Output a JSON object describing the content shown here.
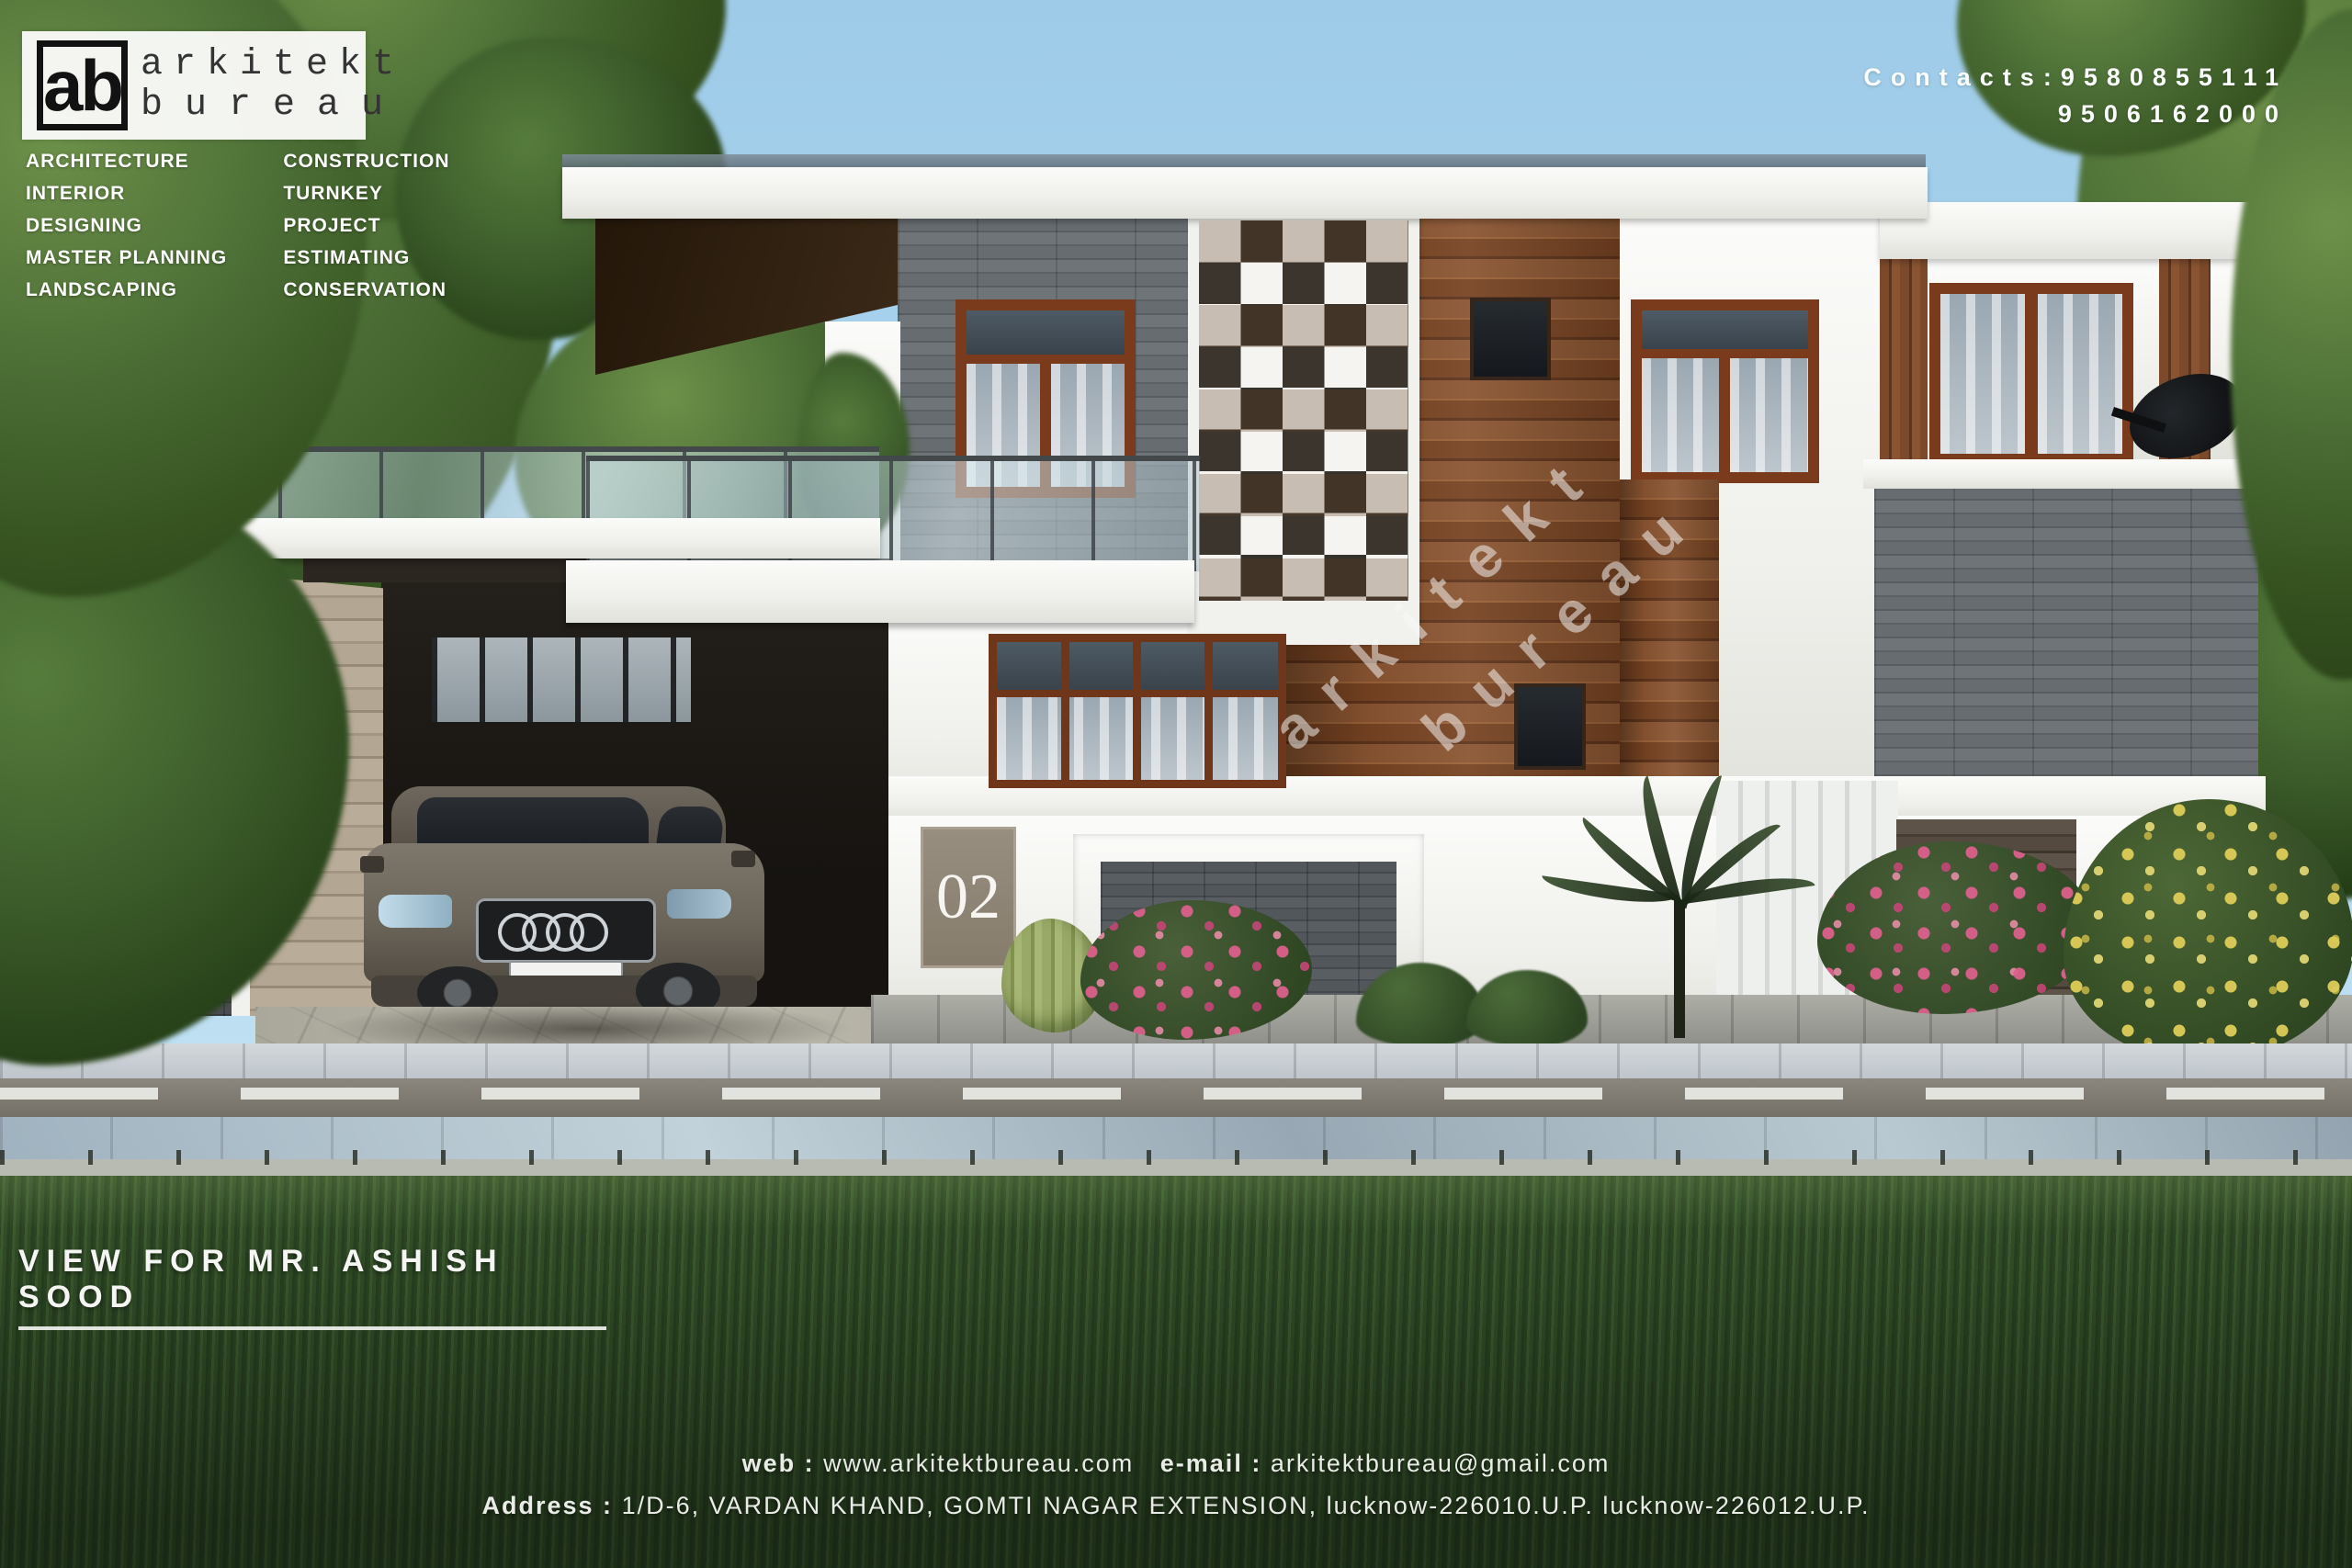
{
  "branding": {
    "logo_abbr": "ab",
    "name_line1": "arkitekt",
    "name_line2": "bureau"
  },
  "services": {
    "left": [
      "ARCHITECTURE",
      "INTERIOR DESIGNING",
      "MASTER PLANNING",
      "LANDSCAPING"
    ],
    "right": [
      "CONSTRUCTION",
      "TURNKEY PROJECT",
      "ESTIMATING",
      "CONSERVATION"
    ]
  },
  "contacts": {
    "line1": "Contacts:9580855111",
    "line2": "9506162000"
  },
  "watermark": {
    "line1": "arkitekt",
    "line2": "bureau"
  },
  "house": {
    "number": "02"
  },
  "caption": "VIEW FOR MR. ASHISH SOOD",
  "footer": {
    "web_label": "web :",
    "web_value": "www.arkitektbureau.com",
    "email_label": "e-mail :",
    "email_value": "arkitektbureau@gmail.com",
    "address_label": "Address :",
    "address_value": "1/D-6, VARDAN KHAND, GOMTI NAGAR EXTENSION, lucknow-226010.U.P. lucknow-226012.U.P."
  },
  "colors": {
    "sky": "#aad4ee",
    "grass": "#35512a",
    "wood": "#7d4a28",
    "stone": "#5e6367",
    "accent_white": "#f2f2ef"
  }
}
